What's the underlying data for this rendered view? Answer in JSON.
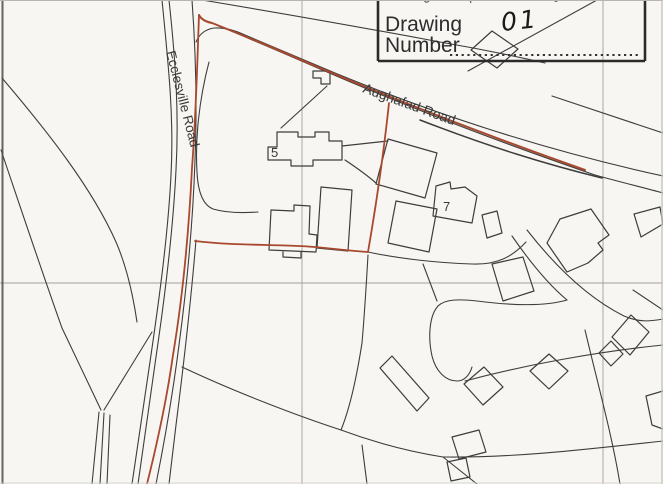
{
  "title_block": {
    "field_label_line1": "Drawing",
    "field_label_line2": "Number",
    "drawing_number_value": "01",
    "leader_style": "dotted"
  },
  "map": {
    "road_labels": {
      "ecclesville": "Ecclesville Road",
      "aughafad": "Aughafad Road"
    },
    "plot_numbers": {
      "plot_5": "5",
      "plot_7": "7"
    },
    "colors": {
      "paper": "#f8f6f2",
      "map_line": "#3d3d3d",
      "site_boundary_red": "#a8492f",
      "grid_line": "#a3a09b",
      "frame": "#2b2b2b",
      "label_text": "#3a3a3a",
      "title_text": "#2d2d2d",
      "handwriting": "#1a1a1a"
    }
  }
}
